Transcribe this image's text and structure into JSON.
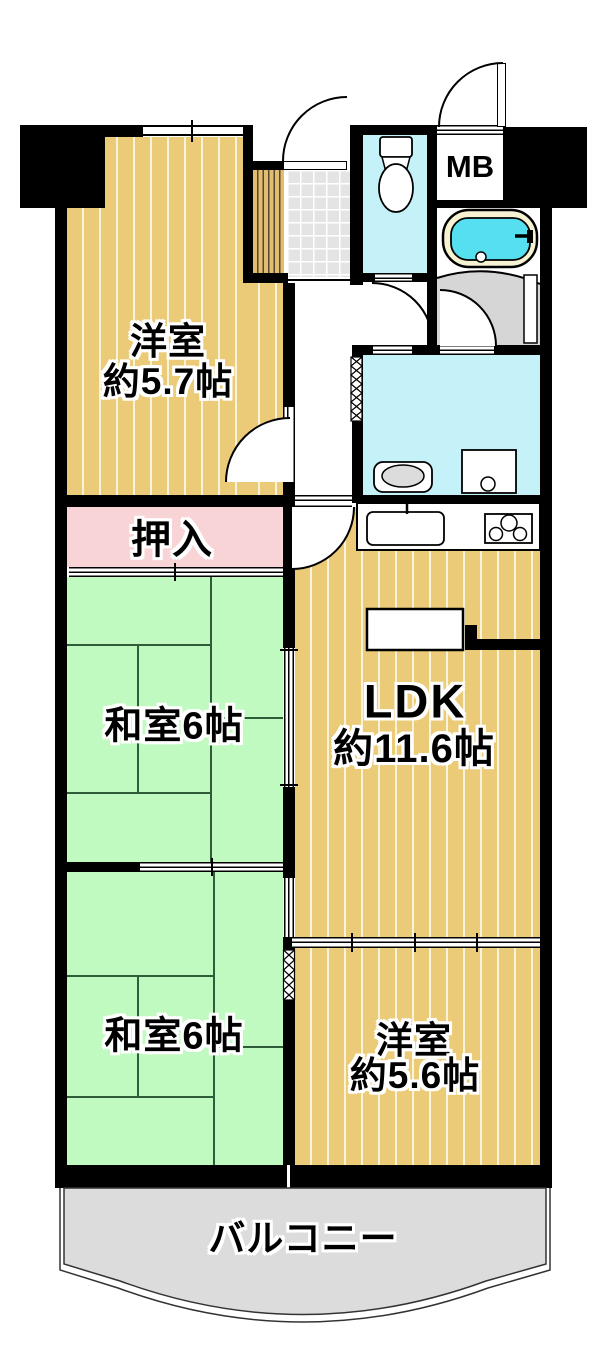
{
  "floorplan": {
    "rooms": {
      "western1": {
        "name": "洋室",
        "size": "約5.7帖"
      },
      "closet": {
        "label": "押入"
      },
      "japanese1": {
        "label": "和室6帖"
      },
      "japanese2": {
        "label": "和室6帖"
      },
      "ldk": {
        "name": "LDK",
        "size": "約11.6帖"
      },
      "western2": {
        "name": "洋室",
        "size": "約5.6帖"
      },
      "balcony": {
        "label": "バルコニー"
      },
      "meter_box": {
        "label": "MB"
      }
    },
    "colors": {
      "wall": "#000000",
      "wood_floor": "#ebcb77",
      "wood_stripe": "#f9f3da",
      "plank": "#e2bc70",
      "plank_line": "#54482e",
      "tatami": "#c1fac1",
      "tatami_line": "#2f5d3a",
      "closet_pink": "#f9d4d6",
      "wet_area_cyan": "#c5f2f8",
      "tub_water": "#55dff0",
      "tub_rim": "#f7f3d2",
      "tile_gray": "#e4e4e4",
      "floor_gray": "#d6d6d6",
      "balcony_gray": "#dcdcdc"
    }
  }
}
